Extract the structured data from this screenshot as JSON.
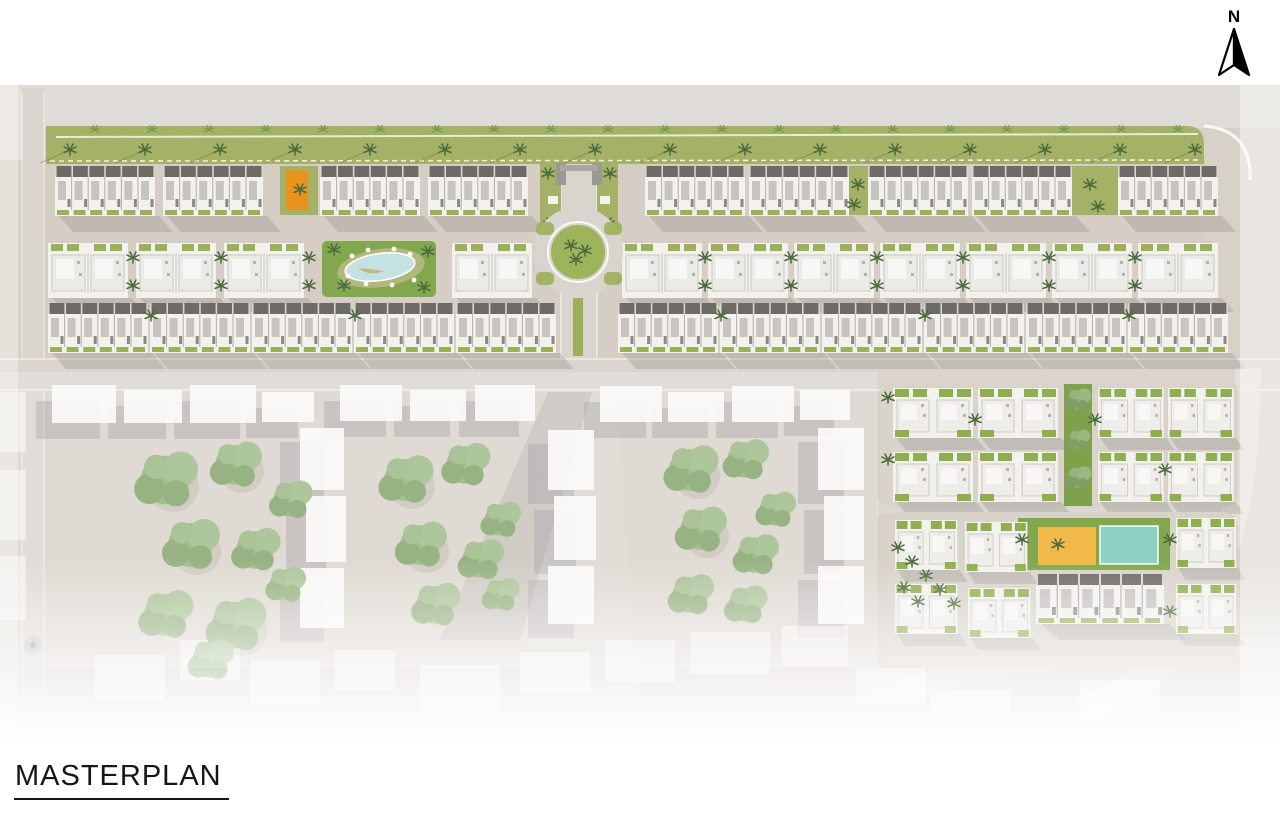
{
  "title": {
    "label": "MASTERPLAN"
  },
  "compass": {
    "label": "N"
  },
  "palette": {
    "canvas": "#d8d1c8",
    "canvas_top": "#dfdbd6",
    "ground": "#d3cabf",
    "green_strip": "#a4b166",
    "lawn": "#83a74f",
    "garden": "#9cb05a",
    "palm": "#4a6b3c",
    "palm_light": "#6f9b4e",
    "tree": "#8fae77",
    "tree_dark": "#7ea065",
    "bldg": "#f2f1ee",
    "bldg_shade": "#c9c6c1",
    "bldg_band": "#6e6a66",
    "unit_panel": "#c7c4bf",
    "shadow": "#8b8785",
    "ctx_shadow": "#969296",
    "pool_blue": "#c3e2e1",
    "pool_teal": "#8fd2c5",
    "deck_sand": "#f1b84a",
    "accent_orange": "#e8931d",
    "road": "#d9d4cd",
    "curb": "#ffffff",
    "ink": "#161616"
  }
}
